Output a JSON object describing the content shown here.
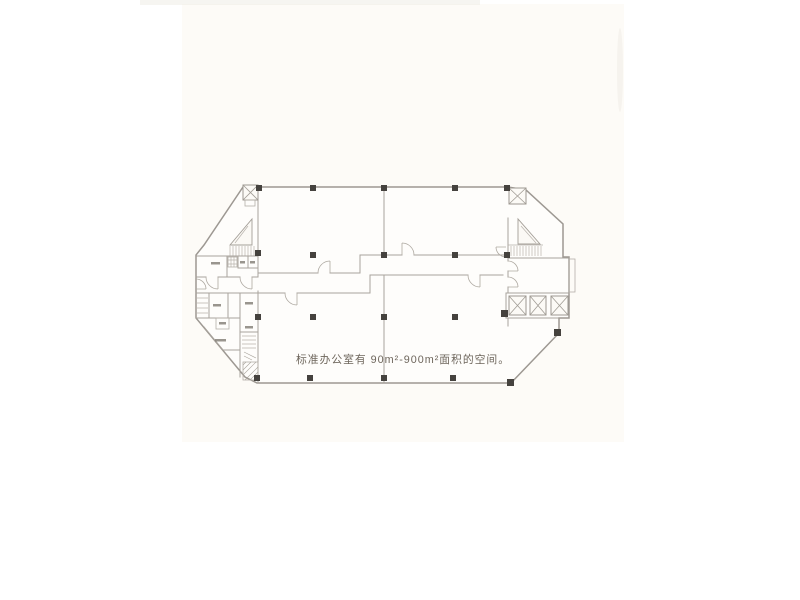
{
  "photo": {
    "caption": "标准办公室有 90m²-900m²面积的空间。",
    "area_min": "90m²",
    "area_max": "900m²"
  },
  "colors": {
    "paper": "#fdfbf7",
    "wall": "#a8a39c",
    "column": "#45423e",
    "caption_text": "#6e665c"
  }
}
